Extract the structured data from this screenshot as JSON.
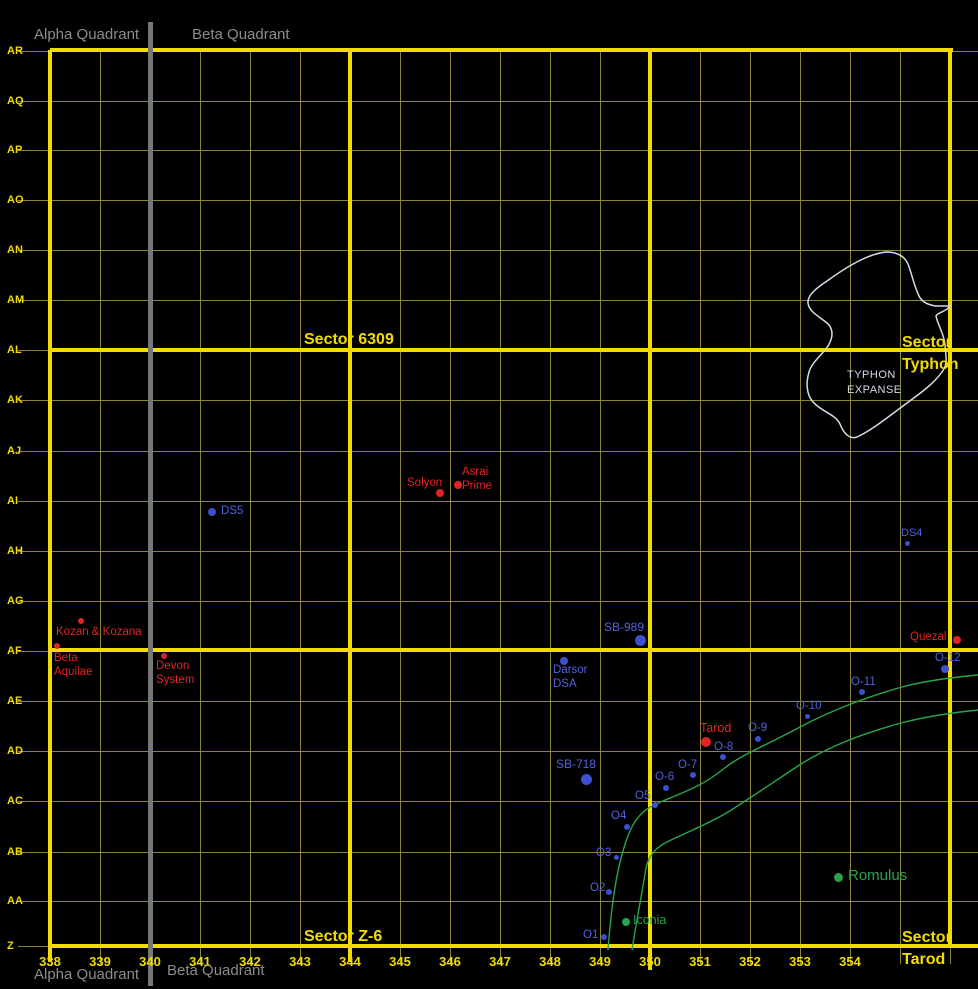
{
  "colors": {
    "accent_yellow": "#f2dc00",
    "grid_dim": "#8d8536",
    "grey": "#8c8c8c",
    "red": "#e02525",
    "blue_dot": "#3f4fd1",
    "blue_label": "#5461de",
    "green": "#2aa34c",
    "region_outline": "#d9d9ea",
    "background": "#000000"
  },
  "quadrant_labels": {
    "top_alpha": "Alpha Quadrant",
    "top_beta": "Beta Quadrant",
    "bottom_alpha": "Alpha Quadrant",
    "bottom_beta": "Beta Quadrant"
  },
  "axes": {
    "rows": [
      {
        "label": "AR",
        "y": 51
      },
      {
        "label": "AQ",
        "y": 101
      },
      {
        "label": "AP",
        "y": 150
      },
      {
        "label": "AO",
        "y": 200
      },
      {
        "label": "AN",
        "y": 250
      },
      {
        "label": "AM",
        "y": 300
      },
      {
        "label": "AL",
        "y": 350
      },
      {
        "label": "AK",
        "y": 400
      },
      {
        "label": "AJ",
        "y": 451
      },
      {
        "label": "AI",
        "y": 501
      },
      {
        "label": "AH",
        "y": 551
      },
      {
        "label": "AG",
        "y": 601
      },
      {
        "label": "AF",
        "y": 651
      },
      {
        "label": "AE",
        "y": 701
      },
      {
        "label": "AD",
        "y": 751
      },
      {
        "label": "AC",
        "y": 801
      },
      {
        "label": "AB",
        "y": 852
      },
      {
        "label": "AA",
        "y": 901
      },
      {
        "label": "Z",
        "y": 946
      }
    ],
    "cols": [
      {
        "label": "338",
        "x": 50
      },
      {
        "label": "339",
        "x": 100
      },
      {
        "label": "340",
        "x": 150
      },
      {
        "label": "341",
        "x": 200
      },
      {
        "label": "342",
        "x": 250
      },
      {
        "label": "343",
        "x": 300
      },
      {
        "label": "344",
        "x": 350
      },
      {
        "label": "345",
        "x": 400
      },
      {
        "label": "346",
        "x": 450
      },
      {
        "label": "347",
        "x": 500
      },
      {
        "label": "348",
        "x": 550
      },
      {
        "label": "349",
        "x": 600
      },
      {
        "label": "350",
        "x": 650
      },
      {
        "label": "351",
        "x": 700
      },
      {
        "label": "352",
        "x": 750
      },
      {
        "label": "353",
        "x": 800
      },
      {
        "label": "354",
        "x": 850
      }
    ]
  },
  "grid": {
    "thin_cols": [
      100,
      200,
      250,
      300,
      400,
      450,
      500,
      550,
      600,
      700,
      750,
      800,
      850,
      900,
      950
    ],
    "thin_col_y1": 50,
    "thin_col_y2": 964,
    "thin_row_x1": 18,
    "thin_row_x2": 978,
    "thick_rows": [
      {
        "y": 50,
        "x1": 50,
        "x2": 953
      },
      {
        "y": 350,
        "x1": 50,
        "x2": 978
      },
      {
        "y": 650,
        "x1": 50,
        "x2": 978
      },
      {
        "y": 946,
        "x1": 50,
        "x2": 978
      }
    ],
    "thick_cols": [
      {
        "x": 50,
        "y1": 50,
        "y2": 962
      },
      {
        "x": 350,
        "y1": 50,
        "y2": 962
      },
      {
        "x": 650,
        "y1": 50,
        "y2": 970
      },
      {
        "x": 950,
        "y1": 50,
        "y2": 948
      }
    ],
    "divider_x": 148,
    "divider_y1": 22,
    "divider_y2": 986
  },
  "sector_labels": [
    {
      "name": "sector-6309",
      "text": "Sector 6309",
      "x": 304,
      "y": 329
    },
    {
      "name": "sector-typhon",
      "text": "Sector\nTyphon",
      "x": 902,
      "y": 332
    },
    {
      "name": "sector-z6",
      "text": "Sector Z-6",
      "x": 304,
      "y": 926
    },
    {
      "name": "sector-tarod",
      "text": "Sector\nTarod",
      "x": 902,
      "y": 927
    }
  ],
  "regions": {
    "typhon_expanse": {
      "label": "TYPHON\nEXPANSE",
      "label_x": 847,
      "label_y": 368,
      "path": "M 886 252 C 896 252 904 255 908 264 C 912 274 914 286 919 296 C 922 302 928 305 936 306 L 950 306 C 946 312 938 312 936 316 C 938 326 944 333 945 345 C 946 358 948 364 942 372 C 932 386 916 396 903 406 C 888 417 872 430 857 437 C 849 440 843 432 840 424 C 835 414 822 412 813 402 C 806 394 806 382 809 372 C 812 362 822 355 828 346 C 833 338 834 329 827 323 C 820 317 809 312 808 303 C 807 295 818 287 827 281 C 845 268 867 254 886 252 Z"
    }
  },
  "neutral_zone": {
    "paths": [
      "M 608 950 C 611 912 615 878 623 851 C 630 826 638 812 656 804 C 676 795 700 788 722 770 C 742 754 765 746 800 727 C 828 712 866 697 902 687 C 928 680 956 677 978 675",
      "M 632 950 C 637 918 642 893 646 868 C 649 855 656 847 669 841 C 690 831 712 822 728 812 C 752 797 778 779 801 764 C 828 747 864 733 901 723 C 928 716 958 712 978 710"
    ]
  },
  "points": [
    {
      "name": "kozan-kozana",
      "label": "Kozan & Kozana",
      "type": "red",
      "x": 81,
      "y": 621,
      "r": 3,
      "lx": 56,
      "ly": 626,
      "fs": 11.5
    },
    {
      "name": "beta-aquilae",
      "label": "Beta\nAquilae",
      "type": "red",
      "x": 57,
      "y": 646,
      "r": 3,
      "lx": 54,
      "ly": 652,
      "fs": 11.5
    },
    {
      "name": "devon-system",
      "label": "Devon\nSystem",
      "type": "red",
      "x": 164,
      "y": 656,
      "r": 3,
      "lx": 156,
      "ly": 660,
      "fs": 11.5
    },
    {
      "name": "solyon",
      "label": "Solyon",
      "type": "red",
      "x": 440,
      "y": 493,
      "r": 4,
      "lx": 407,
      "ly": 477,
      "fs": 11.5
    },
    {
      "name": "asrai-prime",
      "label": "Asrai\nPrime",
      "type": "red",
      "x": 458,
      "y": 485,
      "r": 4,
      "lx": 462,
      "ly": 466,
      "fs": 11.5
    },
    {
      "name": "tarod",
      "label": "Tarod",
      "type": "red",
      "x": 706,
      "y": 742,
      "r": 5,
      "lx": 700,
      "ly": 721,
      "fs": 12.5
    },
    {
      "name": "quezal",
      "label": "Quezal",
      "type": "red",
      "x": 957,
      "y": 640,
      "r": 4,
      "lx": 910,
      "ly": 631,
      "fs": 11.5
    },
    {
      "name": "ds5",
      "label": "DS5",
      "type": "blue",
      "x": 212,
      "y": 512,
      "r": 4,
      "lx": 221,
      "ly": 505,
      "fs": 11.5
    },
    {
      "name": "ds4",
      "label": "DS4",
      "type": "blue",
      "x": 907,
      "y": 543,
      "r": 2.5,
      "lx": 901,
      "ly": 527,
      "fs": 11
    },
    {
      "name": "sb-989",
      "label": "SB-989",
      "type": "blue",
      "x": 640,
      "y": 640,
      "r": 5.5,
      "lx": 604,
      "ly": 620,
      "fs": 12
    },
    {
      "name": "darsor-dsa",
      "label": "Darsor\nDSA",
      "type": "blue",
      "x": 564,
      "y": 661,
      "r": 4,
      "lx": 553,
      "ly": 664,
      "fs": 11.5
    },
    {
      "name": "sb-718",
      "label": "SB-718",
      "type": "blue",
      "x": 586,
      "y": 779,
      "r": 5.5,
      "lx": 556,
      "ly": 757,
      "fs": 12
    },
    {
      "name": "o-12",
      "label": "O-12",
      "type": "blue",
      "x": 945,
      "y": 669,
      "r": 4,
      "lx": 935,
      "ly": 652,
      "fs": 11.5
    },
    {
      "name": "o-11",
      "label": "O-11",
      "type": "blue",
      "x": 862,
      "y": 692,
      "r": 3,
      "lx": 851,
      "ly": 676,
      "fs": 11.5
    },
    {
      "name": "o-10",
      "label": "O-10",
      "type": "blue",
      "x": 807,
      "y": 716,
      "r": 2.5,
      "lx": 796,
      "ly": 700,
      "fs": 11.5
    },
    {
      "name": "o-9",
      "label": "O-9",
      "type": "blue",
      "x": 758,
      "y": 739,
      "r": 3,
      "lx": 748,
      "ly": 722,
      "fs": 11.5
    },
    {
      "name": "o-8",
      "label": "O-8",
      "type": "blue",
      "x": 723,
      "y": 757,
      "r": 3,
      "lx": 714,
      "ly": 741,
      "fs": 11.5
    },
    {
      "name": "o-7",
      "label": "O-7",
      "type": "blue",
      "x": 693,
      "y": 775,
      "r": 3,
      "lx": 678,
      "ly": 759,
      "fs": 11.5
    },
    {
      "name": "o-6",
      "label": "O-6",
      "type": "blue",
      "x": 666,
      "y": 788,
      "r": 3,
      "lx": 655,
      "ly": 771,
      "fs": 11.5
    },
    {
      "name": "o5",
      "label": "O5",
      "type": "blue",
      "x": 655,
      "y": 805,
      "r": 3,
      "lx": 635,
      "ly": 790,
      "fs": 11.5
    },
    {
      "name": "o4",
      "label": "O4",
      "type": "blue",
      "x": 627,
      "y": 827,
      "r": 3,
      "lx": 611,
      "ly": 810,
      "fs": 11.5
    },
    {
      "name": "o3",
      "label": "O3",
      "type": "blue",
      "x": 616,
      "y": 857,
      "r": 2.5,
      "lx": 596,
      "ly": 847,
      "fs": 11.5
    },
    {
      "name": "o2",
      "label": "O2",
      "type": "blue",
      "x": 609,
      "y": 892,
      "r": 3,
      "lx": 590,
      "ly": 882,
      "fs": 11.5
    },
    {
      "name": "o1",
      "label": "O1",
      "type": "blue",
      "x": 604,
      "y": 937,
      "r": 3,
      "lx": 583,
      "ly": 929,
      "fs": 11.5
    },
    {
      "name": "romulus",
      "label": "Romulus",
      "type": "green",
      "x": 838,
      "y": 877,
      "r": 4.5,
      "lx": 848,
      "ly": 867,
      "fs": 15
    },
    {
      "name": "iconia",
      "label": "Iconia",
      "type": "green",
      "x": 626,
      "y": 922,
      "r": 4,
      "lx": 633,
      "ly": 913,
      "fs": 12.5
    }
  ]
}
